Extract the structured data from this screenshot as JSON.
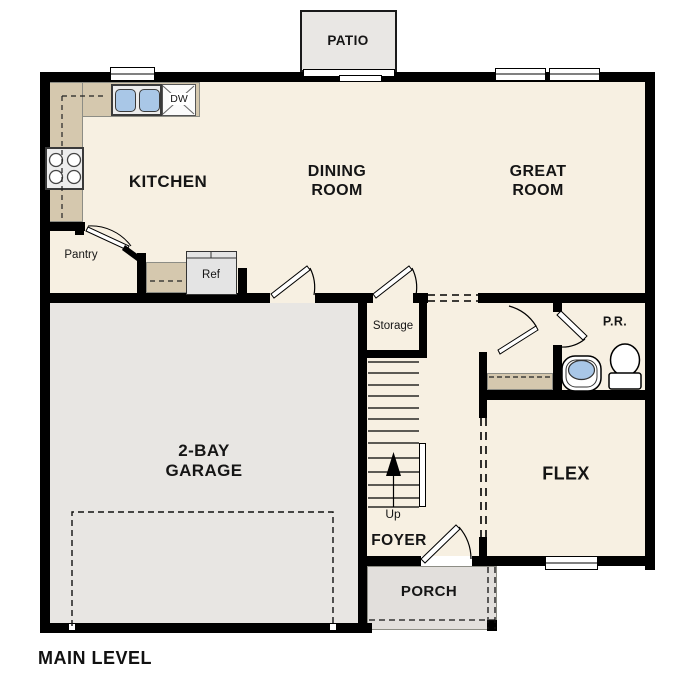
{
  "title": "MAIN LEVEL",
  "rooms": {
    "patio": {
      "label": "PATIO"
    },
    "kitchen": {
      "label": "KITCHEN"
    },
    "dining": {
      "label": "DINING\nROOM"
    },
    "great": {
      "label": "GREAT\nROOM"
    },
    "garage": {
      "label": "2-BAY\nGARAGE"
    },
    "flex": {
      "label": "FLEX"
    },
    "foyer": {
      "label": "FOYER"
    },
    "porch": {
      "label": "PORCH"
    },
    "powder": {
      "label": "P.R."
    }
  },
  "annotations": {
    "storage": "Storage",
    "up": "Up",
    "pantry": "Pantry",
    "refrigerator": "Ref",
    "dishwasher": "DW"
  },
  "colors": {
    "floor": "#f7f0e2",
    "garage": "#e8e6e3",
    "porch": "#e2dfdc",
    "patio": "#e9e7e4",
    "counter": "#d5c8ae",
    "fixture_blue": "#a9c7e7",
    "wall": "#000000"
  }
}
